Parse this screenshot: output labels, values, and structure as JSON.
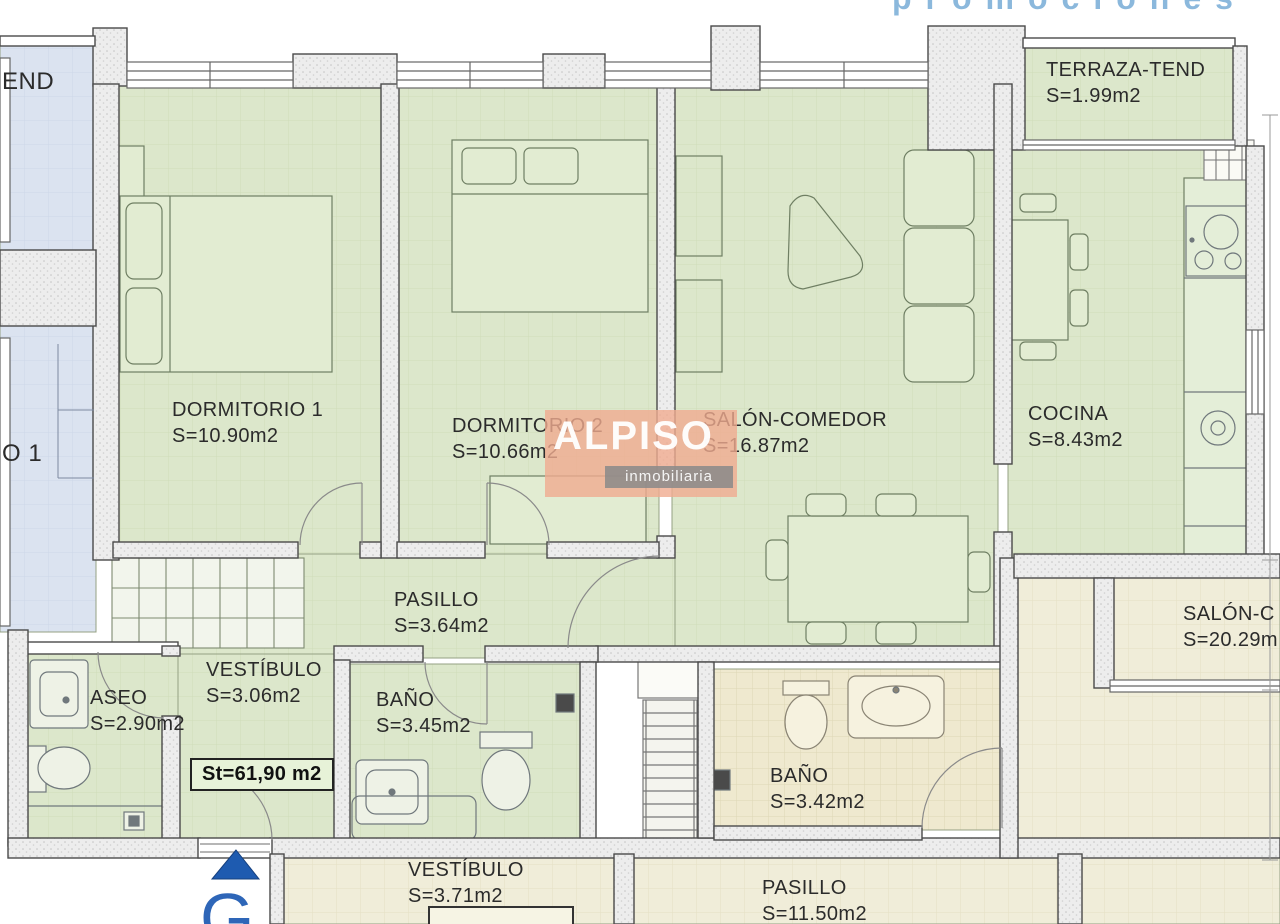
{
  "header": {
    "partial_text": "promociones"
  },
  "watermark": {
    "brand": "ALPISO",
    "subtitle": "inmobiliaria"
  },
  "unit": {
    "entrance_letter": "G",
    "total_label": "St=61,90 m2",
    "rooms": {
      "terraza": {
        "name": "TERRAZA-TEND",
        "area": "S=1.99m2"
      },
      "dormitorio1": {
        "name": "DORMITORIO 1",
        "area": "S=10.90m2"
      },
      "dormitorio2": {
        "name": "DORMITORIO 2",
        "area": "S=10.66m2"
      },
      "salon": {
        "name": "SALÓN-COMEDOR",
        "area": "S=16.87m2"
      },
      "cocina": {
        "name": "COCINA",
        "area": "S=8.43m2"
      },
      "pasillo": {
        "name": "PASILLO",
        "area": "S=3.64m2"
      },
      "vestibulo": {
        "name": "VESTÍBULO",
        "area": "S=3.06m2"
      },
      "aseo": {
        "name": "ASEO",
        "area": "S=2.90m2"
      },
      "bano": {
        "name": "BAÑO",
        "area": "S=3.45m2"
      }
    }
  },
  "adjacent_left": {
    "terraza_fragment": "END",
    "dormitorio_fragment": "O 1"
  },
  "adjacent_bottom": {
    "rooms": {
      "bano": {
        "name": "BAÑO",
        "area": "S=3.42m2"
      },
      "vestibulo": {
        "name": "VESTÍBULO",
        "area": "S=3.71m2"
      },
      "pasillo": {
        "name": "PASILLO",
        "area": "S=11.50m2"
      },
      "salon": {
        "name": "SALÓN-C",
        "area": "S=20.29m"
      }
    }
  },
  "colors": {
    "wall_fill": "#ededed",
    "wall_stroke": "#4a4a4a",
    "floor_main": "#dce7cb",
    "floor_left_unit": "#dbe3f0",
    "floor_bottom_unit": "#f0edd9",
    "watermark_fill": "#f0ab90",
    "entrance_blue": "#1e5bb0",
    "promo_text_blue": "#8bb8dc"
  }
}
